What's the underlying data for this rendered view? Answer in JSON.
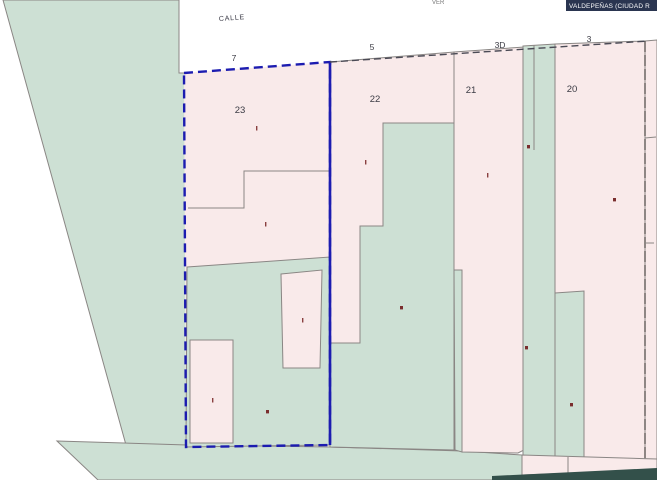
{
  "header": {
    "municipality_badge": "VALDEPEÑAS (CIUDAD R",
    "street_label": "CALLE",
    "street_name_cutoff": "VER"
  },
  "house_numbers": {
    "n7": "7",
    "n5": "5",
    "n3d": "3D",
    "n3": "3"
  },
  "parcel_numbers": {
    "p23": "23",
    "p22": "22",
    "p21": "21",
    "p20": "20"
  },
  "selection": {
    "selected_parcel": "23"
  },
  "colors": {
    "parcel_fill": "#f9eaea",
    "courtyard_fill": "#cde0d4",
    "boundary_line": "#8a8684",
    "selection_outline": "#1c1cb0",
    "road_bar": "#33504a",
    "badge_background": "#2a3550",
    "construction_mark": "#7a2e2e",
    "street_background": "#ffffff"
  }
}
